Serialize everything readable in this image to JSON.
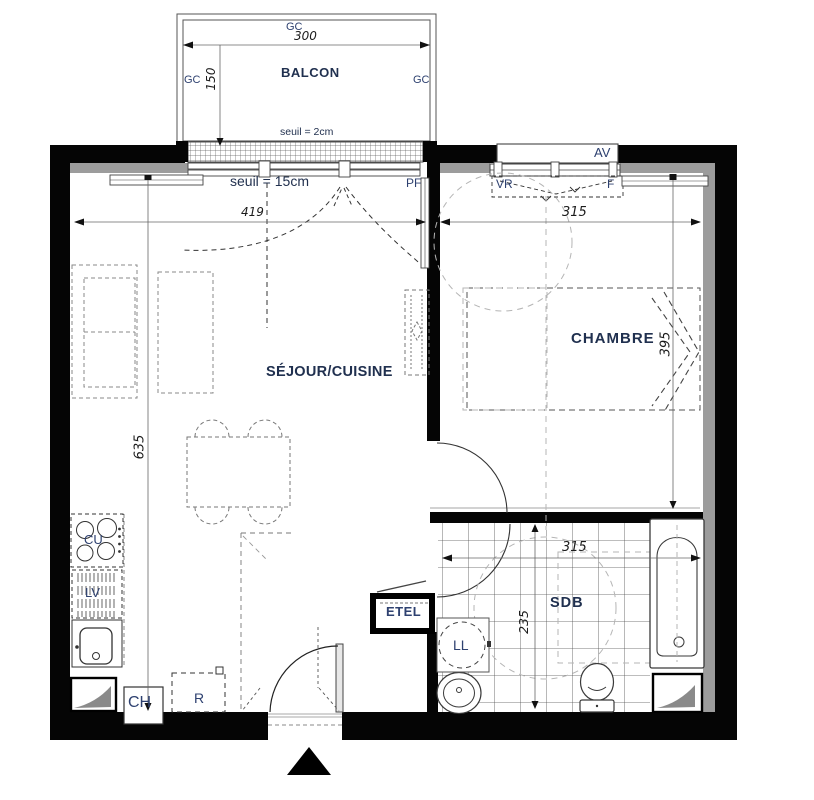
{
  "plan_type": "apartment-floor-plan",
  "rooms": {
    "balcony": "BALCON",
    "living_kitchen": "SÉJOUR/CUISINE",
    "bedroom": "CHAMBRE",
    "bathroom": "SDB"
  },
  "fixtures": {
    "gc": "GC",
    "av": "AV",
    "vr": "VR",
    "f": "F",
    "pf": "PF",
    "cooktop": "CU",
    "dishwasher": "LV",
    "boiler": "CH",
    "fridge": "R",
    "electrical_panel": "ETEL",
    "washing_machine": "LL"
  },
  "dimensions": {
    "balcony_width": "300",
    "balcony_depth": "150",
    "living_width": "419",
    "living_length": "635",
    "bedroom_width": "315",
    "bedroom_length": "395",
    "bathroom_width": "315",
    "bathroom_depth": "235"
  },
  "thresholds": {
    "balcony": "seuil = 2cm",
    "living": "seuil = 15cm"
  },
  "colors": {
    "wall": "#050505",
    "insulation": "#9c9c9c",
    "label": "#2e4170",
    "room_label": "#20304f",
    "dimension_text": "#1c1c1c",
    "clearance_dashed": "#b5b5b5"
  }
}
